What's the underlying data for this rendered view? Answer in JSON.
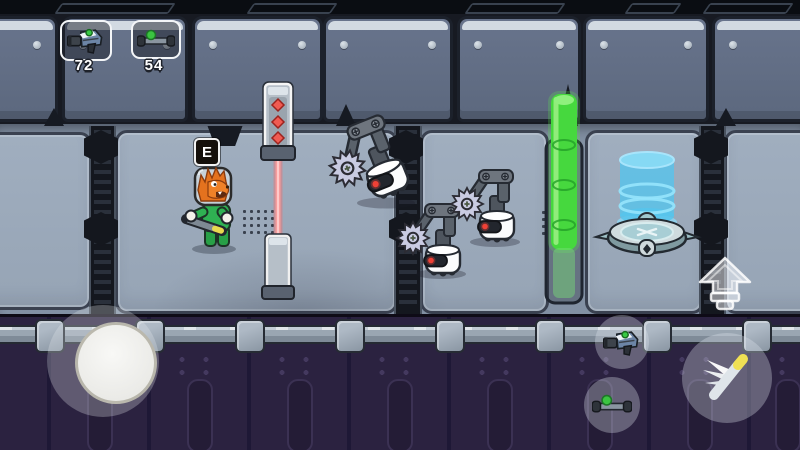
{
  "hud": {
    "slots": [
      {
        "item": "blaster",
        "icon": "blaster-icon",
        "count": "72"
      },
      {
        "item": "hoverboard",
        "icon": "hoverboard-icon",
        "count": "54"
      }
    ]
  },
  "prompt": {
    "key": "E"
  },
  "entities": {
    "player": "lion-astronaut",
    "enemies": [
      "saw-robot",
      "saw-robot",
      "saw-robot"
    ],
    "hazards": [
      "laser-gate",
      "green-energy-barrier"
    ],
    "props": [
      "teleporter-pad",
      "hologram-cylinder-stack"
    ]
  },
  "controls": {
    "joystick": "move-joystick",
    "buttons": [
      {
        "name": "shoot",
        "icon": "blaster-icon"
      },
      {
        "name": "hoverboard",
        "icon": "hoverboard-icon"
      },
      {
        "name": "jump",
        "icon": "up-arrow-icon"
      },
      {
        "name": "dash",
        "icon": "feather-icon"
      }
    ]
  },
  "colors": {
    "laser": "#f08080",
    "barrier_green": "#46d83e",
    "hologram_blue": "#5ac4ec",
    "wall": "#9aa8b9",
    "lower_hull": "#2b2240",
    "accent_green": "#3bc441"
  }
}
